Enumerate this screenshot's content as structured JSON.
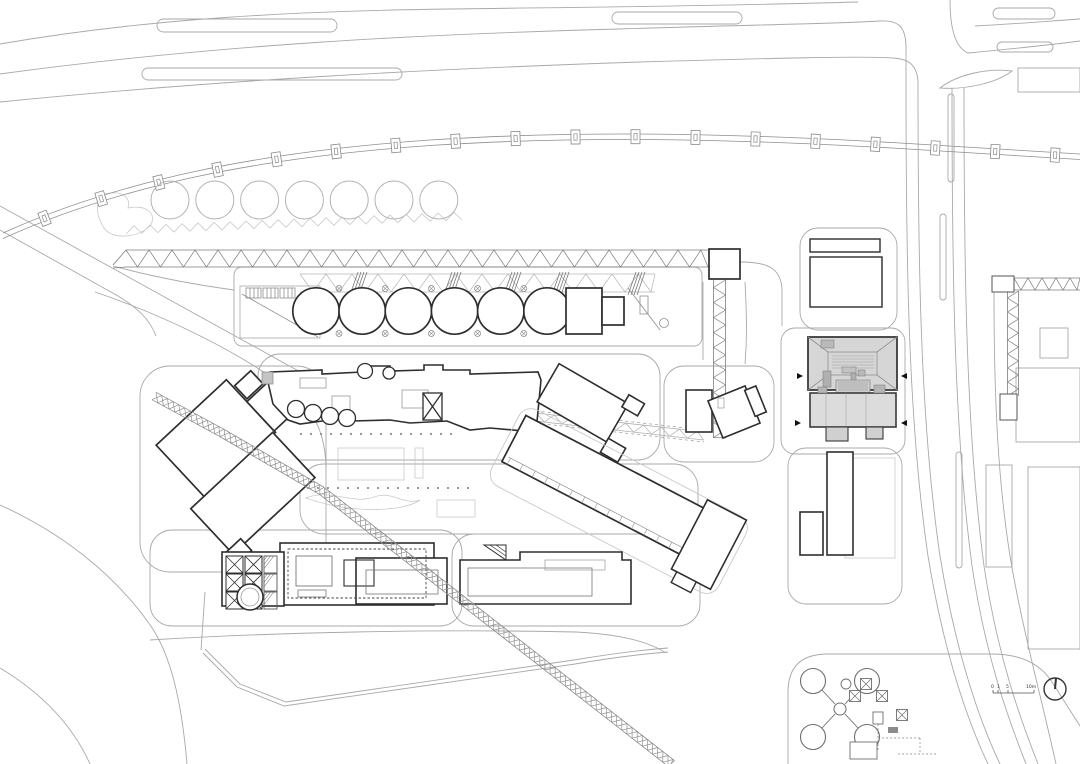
{
  "plan": {
    "scale_bar": {
      "labels": [
        "0",
        "1",
        "5",
        "10m"
      ]
    },
    "north_arrow": {
      "symbol": "north-indicator-circle-with-needle"
    },
    "colors": {
      "background": "#ffffff",
      "road": "#a9a9a9",
      "landscape": "#c9c9c9",
      "detail": "#8f8f8f",
      "truss": "#7d7d7d",
      "building": "#2e2e2e",
      "medium": "#6e6e6e",
      "featured_fill": "#d6d6d6",
      "featured_annex_fill": "#dcdcdc",
      "featured_detail": "#9c9c9c",
      "tick": "#999999",
      "text": "#333333"
    },
    "generated": {
      "trees": {
        "count": 7,
        "cx0": 170,
        "dx": 44.8,
        "cy": 200,
        "r": 19
      },
      "silos": {
        "count": 6,
        "cx0": 316,
        "dx": 46.2,
        "cy": 311,
        "r": 23.2
      },
      "silo_marks": {
        "count": 5,
        "cx0": 339,
        "dx": 46.2,
        "y_top": 288.5,
        "y_bot": 333.5,
        "r": 3
      },
      "gantry_posts": {
        "count": 18,
        "w": 9,
        "h": 14,
        "start": 45,
        "end_margin": 25
      },
      "xbox_grid": {
        "x0": 226,
        "y0": 556,
        "cols": 2,
        "rows": 3,
        "size": 17,
        "dx": 19,
        "dy": 18
      },
      "hatch_col": {
        "x": 264,
        "y0": 556,
        "w": 13,
        "h": 17,
        "rows": 3,
        "dy": 18
      },
      "tick_rows": [
        {
          "x1": 300,
          "x2": 455,
          "y": 433,
          "step": 10
        },
        {
          "x1": 307,
          "x2": 467,
          "y": 487,
          "step": 10
        }
      ],
      "tanks": {
        "centers": [
          [
            813,
            681
          ],
          [
            867,
            681
          ],
          [
            813,
            737
          ],
          [
            867,
            737
          ]
        ],
        "r": 12.5,
        "center_hub": [
          840,
          709,
          6
        ],
        "aux_circle": [
          846,
          684,
          5
        ]
      },
      "equipment_xboxes": [
        [
          866,
          684
        ],
        [
          855,
          696
        ],
        [
          882,
          696
        ],
        [
          902,
          715
        ]
      ],
      "trusses": {
        "horizontal": {
          "x1": 126,
          "y1": 258.5,
          "x2": 708,
          "y2": 258.5,
          "halfW": 8.5,
          "period": 23,
          "mode": "zig"
        },
        "vertical": {
          "x1": 719.5,
          "y1": 280,
          "x2": 719.5,
          "y2": 438,
          "halfW": 6,
          "period": 15,
          "mode": "zig"
        },
        "shallow": {
          "x1": 500,
          "y1": 413,
          "x2": 704,
          "y2": 436,
          "halfW": 4,
          "period": 18,
          "mode": "zig"
        },
        "diagonal": {
          "points": [
            [
              154,
              396
            ],
            [
              222,
              433
            ],
            [
              322,
              491
            ],
            [
              672,
              764
            ]
          ],
          "halfW": 4.2,
          "period": 13,
          "mode": "x"
        },
        "right_h": {
          "x1": 1014,
          "y1": 284,
          "x2": 1080,
          "y2": 284,
          "halfW": 6,
          "period": 14,
          "mode": "zig"
        },
        "right_v": {
          "x1": 1013,
          "y1": 291,
          "x2": 1013,
          "y2": 396,
          "halfW": 5.5,
          "period": 14,
          "mode": "zig"
        },
        "silo_ribbon": {
          "x1": 300,
          "y1": 283,
          "x2": 655,
          "y2": 283,
          "halfW": 9,
          "period": 26,
          "mode": "zig"
        }
      },
      "scallop_band": {
        "x1": 126,
        "y1": 234,
        "x2": 470,
        "y2": 220,
        "amp": 8,
        "period": 16
      },
      "diag_ticks": {
        "x1": 508,
        "x2": 696,
        "y": 506,
        "step": 14,
        "len": 7
      },
      "ribbon_hatches": [
        358,
        452,
        512,
        560,
        636
      ]
    }
  }
}
